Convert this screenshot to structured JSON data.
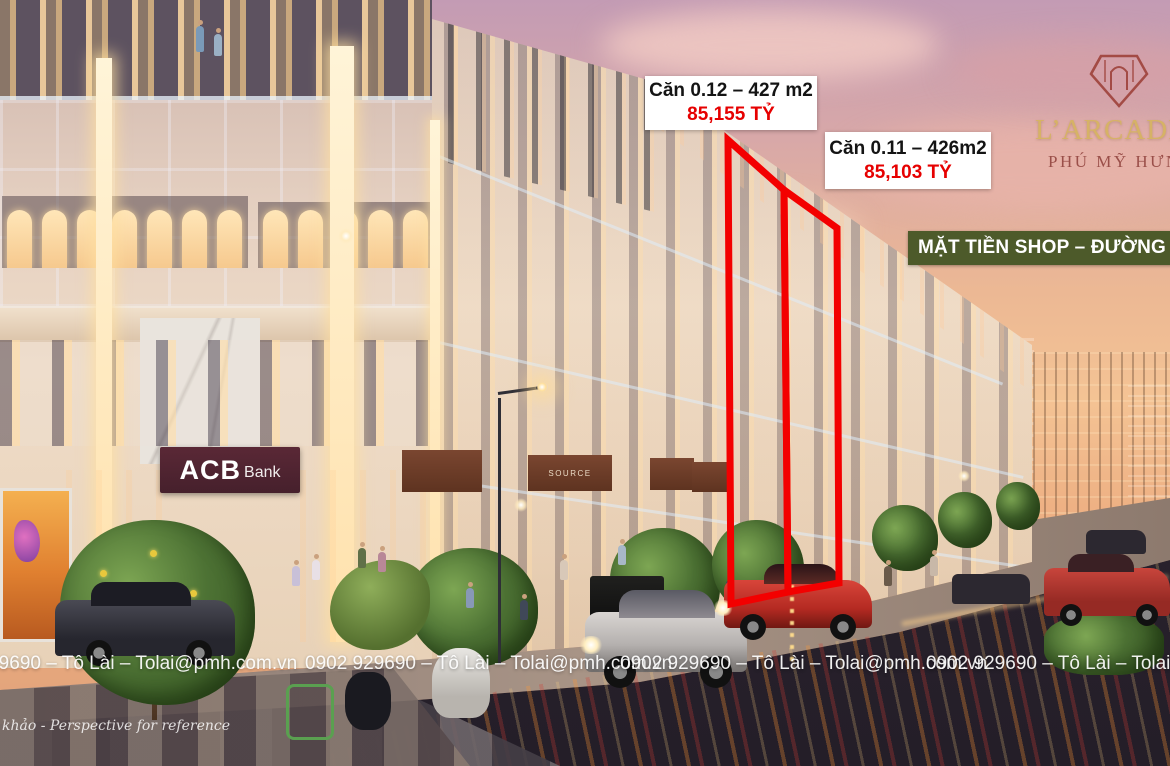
{
  "overlays": {
    "unit_labels": [
      {
        "name": "Căn 0.12 – 427 m2",
        "price": "85,155 TỶ"
      },
      {
        "name": "Căn 0.11 – 426m2",
        "price": "85,103 TỶ"
      }
    ],
    "banner": "MẶT TIỀN SHOP – ĐƯỜNG RỘNG",
    "reference_note": "khảo - Perspective for reference"
  },
  "logo": {
    "title": "L’ARCADE",
    "subtitle": "PHÚ MỸ HƯNG"
  },
  "scene": {
    "acb_sign": {
      "main": "ACB",
      "sub": "Bank"
    },
    "shop_sign": "SOURCE"
  },
  "footer": {
    "watermark": "0902 929690 – Tô Lài – Tolai@pmh.com.vn",
    "repeat_count": 4
  },
  "colors": {
    "highlight_red": "#f30000",
    "price_red": "#e60000",
    "banner_bg": "#4d5a2a",
    "banner_text": "#ffffff",
    "label_bg": "#ffffff",
    "label_text": "#141414",
    "logo_gold": "#d6b266",
    "logo_maroon": "#9a4f49",
    "acb_sign_bg": "#4f222c"
  }
}
